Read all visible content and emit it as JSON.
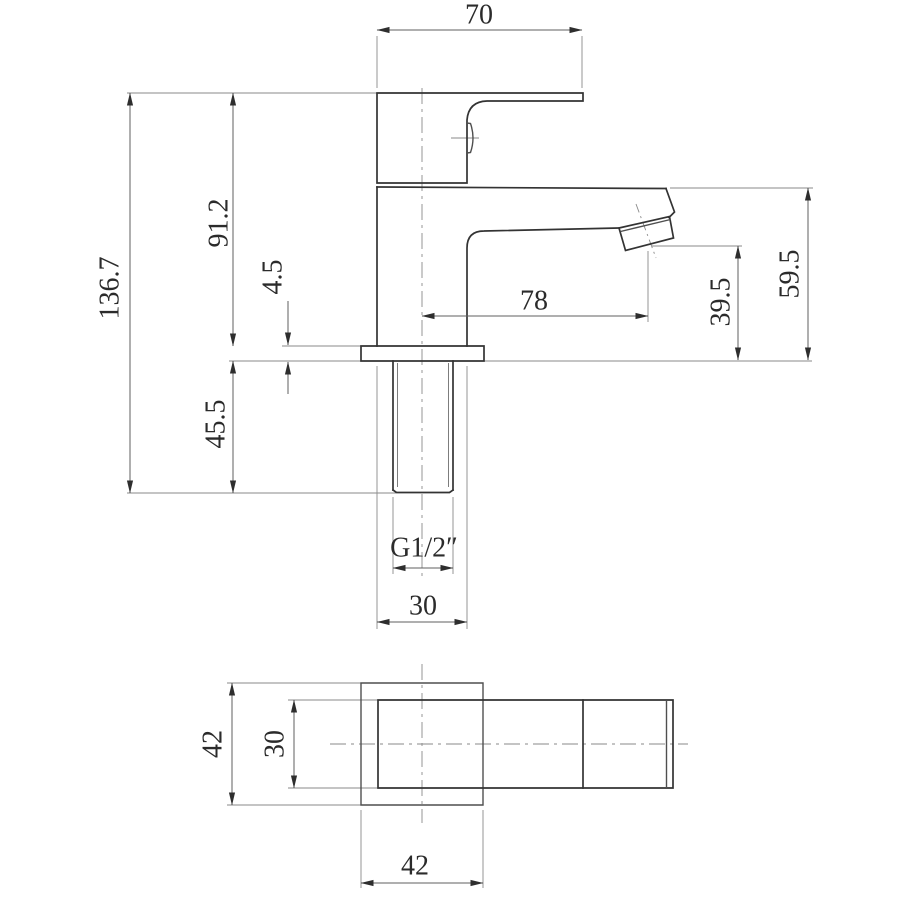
{
  "drawing": {
    "type": "technical-dimension-drawing",
    "subject": "basin tap",
    "units": "mm",
    "side_view": {
      "dims": {
        "handle_width": "70",
        "overall_height": "136.7",
        "height_above_deck": "91.2",
        "base_plate_thickness": "4.5",
        "shank_length": "45.5",
        "spout_reach": "78",
        "outlet_height": "39.5",
        "spout_height": "59.5",
        "thread": "G1/2″",
        "base_width": "30"
      }
    },
    "plan_view": {
      "dims": {
        "base_depth": "42",
        "handle_breadth": "30",
        "base_width": "42"
      }
    },
    "style": {
      "line_color": "#333333",
      "thin_line_color": "#8a8a8a",
      "text_color": "#2b2b2b",
      "background": "#ffffff"
    }
  }
}
